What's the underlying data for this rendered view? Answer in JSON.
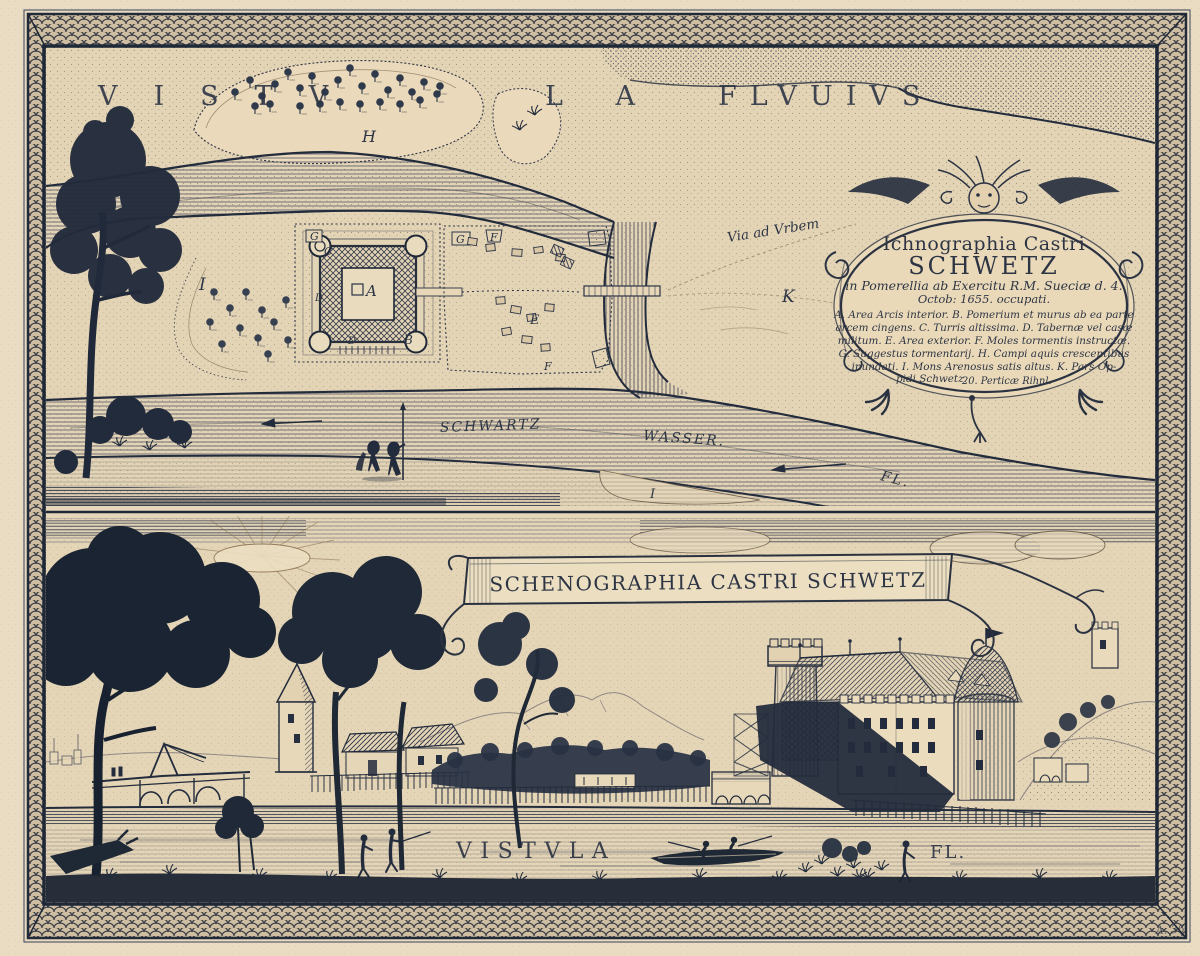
{
  "colors": {
    "paper": "#e6d7ba",
    "paper_light": "#ecdfc6",
    "ink": "#2b3342",
    "ink_dark": "#1e2733",
    "sepia": "#7d6a4f"
  },
  "top_panel": {
    "river_title": {
      "part1": "VISTV",
      "part2": "L A",
      "part3": "FLVUIVS"
    },
    "labels": {
      "island_h": "H",
      "mons_arenosus": "I",
      "town_k": "K",
      "shore_i": "I",
      "via_ad_urbem": "Via ad Vrbem",
      "schwartz": "SCHWARTZ",
      "wasser": "WASSER.",
      "fl": "FL."
    },
    "plan_letters": {
      "a": "A",
      "b": "B",
      "c": "C",
      "d1": "D",
      "d2": "D",
      "e": "E",
      "f1": "F",
      "f2": "F",
      "g1": "G",
      "g2": "G"
    }
  },
  "cartouche": {
    "title_line1": "Ichnographia Castri",
    "title_line2": "SCHWETZ",
    "subtitle_line1": "in Pomerellia ab Exercitu R.M. Sueciæ d. 4.",
    "subtitle_line2": "Octob: 1655. occupati.",
    "legend_line1": "A. Area Arcis interior. B. Pomerium et murus ab ea parte",
    "legend_line2": "arcem cingens. C. Turris altissima. D. Tabernæ vel casæ",
    "legend_line3": "militum. E. Area exterior. F. Moles tormentis instructæ.",
    "legend_line4": "G. Suggestus tormentarij. H. Campi aquis crescentibus",
    "legend_line5": "inundati. I. Mons Arenosus satis altus. K. Pars Op-",
    "legend_line6": "pidi Schwetz.",
    "scale_note": "20. Perticæ Rihnl."
  },
  "bottom_panel": {
    "banner_title": "SCHENOGRAPHIA CASTRI SCHWETZ",
    "river_label": "VISTVLA",
    "river_label_abbrev": "FL."
  },
  "plate_mark": "A. 36."
}
